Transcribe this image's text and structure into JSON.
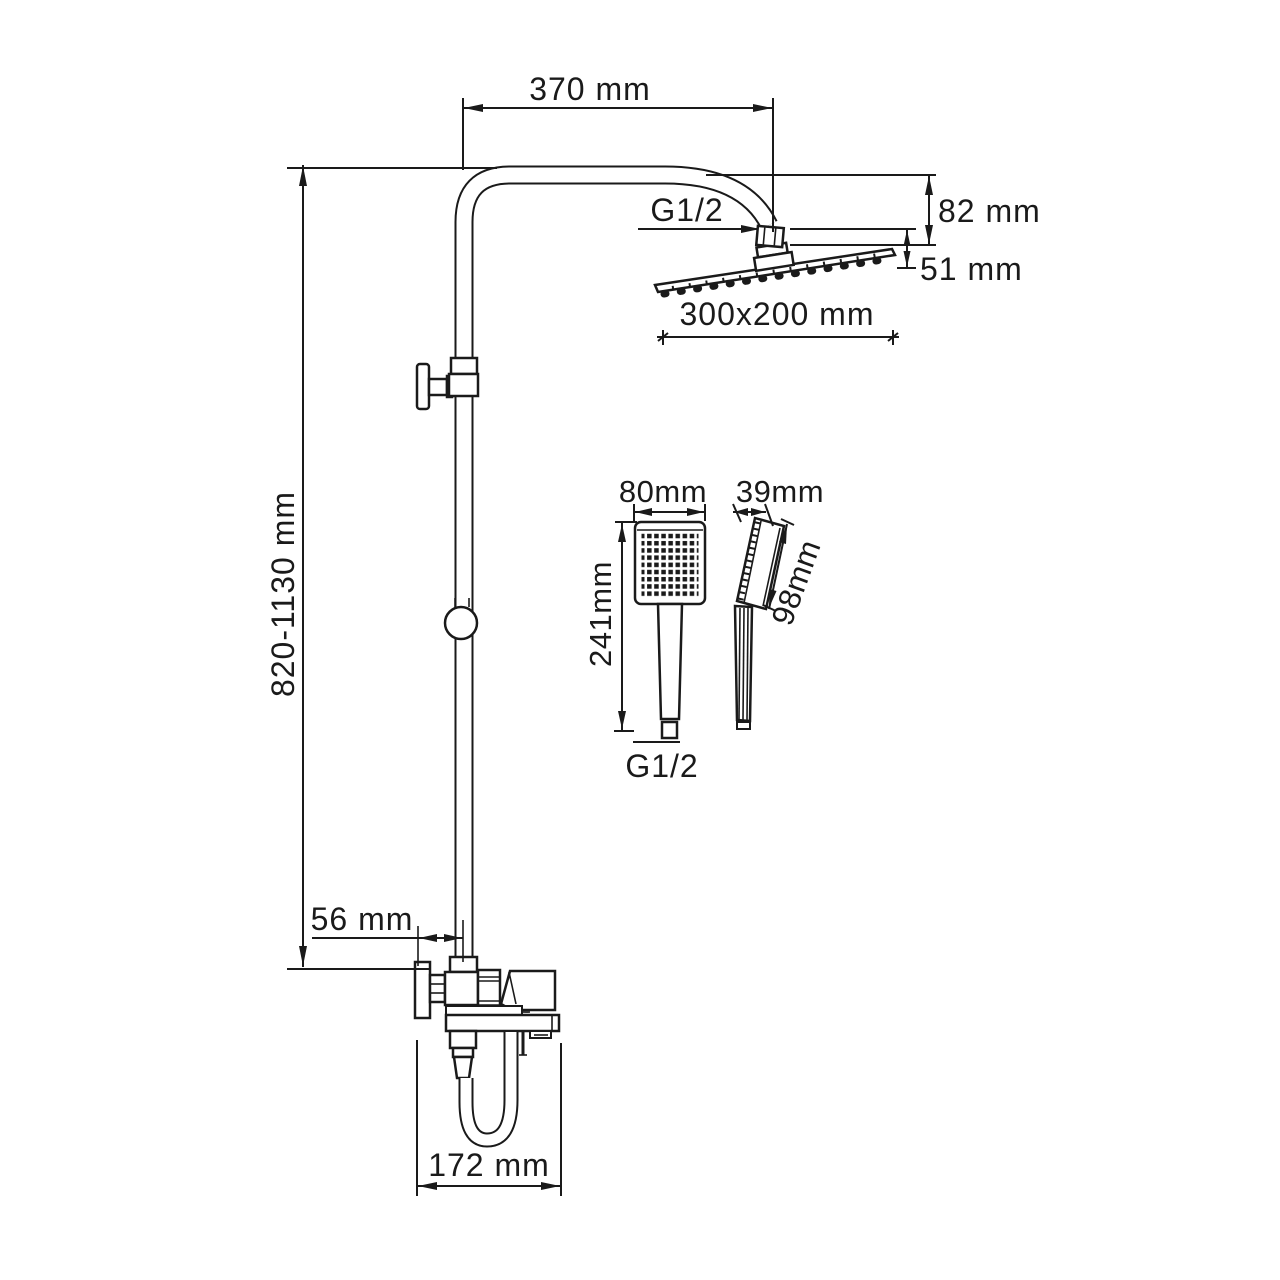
{
  "drawing": {
    "type": "shower-system-dimensional-drawing",
    "units": "mm",
    "colors": {
      "background": "#ffffff",
      "line": "#1a1a1a"
    },
    "dims": {
      "arm_reach": "370 mm",
      "rain_head_thread": "G1/2",
      "rain_head_drop": "82 mm",
      "rain_head_joint_height": "51 mm",
      "rain_head_size": "300x200 mm",
      "column_height_range": "820-1130 mm",
      "handshower_width": "80mm",
      "handshower_depth": "39mm",
      "handshower_length": "241mm",
      "handshower_head_length": "98mm",
      "handshower_thread": "G1/2",
      "wall_to_column": "56 mm",
      "spout_reach": "172 mm"
    }
  }
}
